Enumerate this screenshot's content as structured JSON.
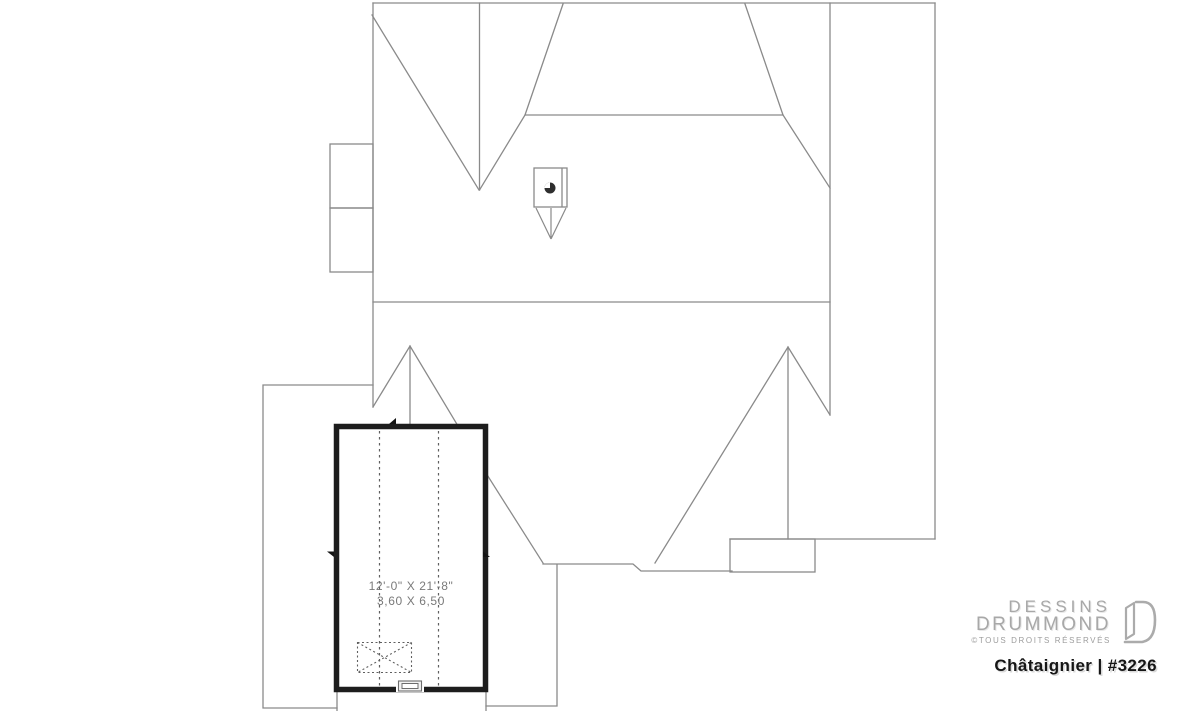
{
  "canvas": {
    "width": 1200,
    "height": 711,
    "background": "#ffffff"
  },
  "drawing": {
    "type": "roof-plan",
    "room_label": {
      "dimensions_imperial": "12'-0\" X 21'-8\"",
      "dimensions_metric": "3,60 X 6,50"
    },
    "colors": {
      "line_gray": "#8a8a8a",
      "wall_black": "#1d1d1d",
      "label_text": "#7a7a7a"
    }
  },
  "branding": {
    "logo_line1": "DESSINS",
    "logo_line2": "DRUMMOND",
    "rights_notice": "©TOUS DROITS RÉSERVÉS",
    "plan_title": "Châtaignier | #3226",
    "colors": {
      "logo_gray": "#a8a8a8",
      "title_black": "#161616"
    }
  }
}
